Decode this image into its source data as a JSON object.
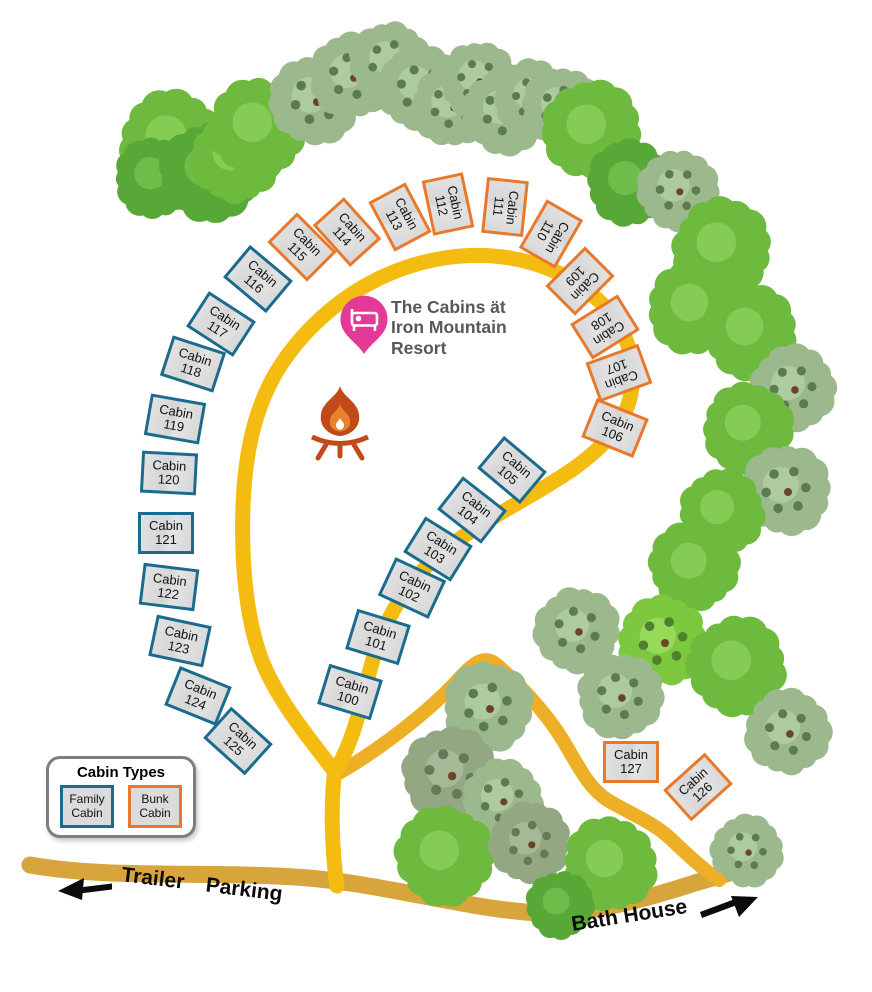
{
  "title": {
    "line1": "The Cabins ät",
    "line2": "Iron Mountain",
    "line3": "Resort"
  },
  "legend": {
    "title": "Cabin Types",
    "family_line1": "Family",
    "family_line2": "Cabin",
    "bunk_line1": "Bunk",
    "bunk_line2": "Cabin"
  },
  "labels": {
    "trailer_parking": "Trailer Parking",
    "bath_house": "Bath House",
    "cabin_word": "Cabin"
  },
  "colors": {
    "road_loop": "#F4BC10",
    "road_branch": "#ECAF25",
    "road_bottom": "#D8A43C",
    "family_border": "#1A6B8E",
    "bunk_border": "#E8782B",
    "cabin_fill": "#DBDBDB",
    "pin": "#E43A97",
    "fire": "#C14A18",
    "fire_inner": "#E8822F",
    "title_text": "#55585C",
    "arrow": "#0C0C0C"
  },
  "cabins": [
    {
      "num": "100",
      "type": "family",
      "x": 350,
      "y": 692,
      "rot": 17
    },
    {
      "num": "101",
      "type": "family",
      "x": 378,
      "y": 637,
      "rot": 17
    },
    {
      "num": "102",
      "type": "family",
      "x": 412,
      "y": 588,
      "rot": 25
    },
    {
      "num": "103",
      "type": "family",
      "x": 438,
      "y": 549,
      "rot": 32
    },
    {
      "num": "104",
      "type": "family",
      "x": 472,
      "y": 510,
      "rot": 38
    },
    {
      "num": "105",
      "type": "family",
      "x": 512,
      "y": 470,
      "rot": 40
    },
    {
      "num": "106",
      "type": "bunk",
      "x": 615,
      "y": 428,
      "rot": 22
    },
    {
      "num": "107",
      "type": "bunk",
      "x": 619,
      "y": 373,
      "rot": 160
    },
    {
      "num": "108",
      "type": "bunk",
      "x": 605,
      "y": 327,
      "rot": 148
    },
    {
      "num": "109",
      "type": "bunk",
      "x": 580,
      "y": 281,
      "rot": 135
    },
    {
      "num": "110",
      "type": "bunk",
      "x": 551,
      "y": 234,
      "rot": 120
    },
    {
      "num": "111",
      "type": "bunk",
      "x": 505,
      "y": 207,
      "rot": 96
    },
    {
      "num": "112",
      "type": "bunk",
      "x": 448,
      "y": 204,
      "rot": 78
    },
    {
      "num": "113",
      "type": "bunk",
      "x": 400,
      "y": 217,
      "rot": 62
    },
    {
      "num": "114",
      "type": "bunk",
      "x": 347,
      "y": 232,
      "rot": 48
    },
    {
      "num": "115",
      "type": "bunk",
      "x": 302,
      "y": 247,
      "rot": 45
    },
    {
      "num": "116",
      "type": "family",
      "x": 258,
      "y": 279,
      "rot": 40
    },
    {
      "num": "117",
      "type": "family",
      "x": 221,
      "y": 324,
      "rot": 33
    },
    {
      "num": "118",
      "type": "family",
      "x": 193,
      "y": 364,
      "rot": 18
    },
    {
      "num": "119",
      "type": "family",
      "x": 175,
      "y": 419,
      "rot": 10
    },
    {
      "num": "120",
      "type": "family",
      "x": 169,
      "y": 473,
      "rot": 3
    },
    {
      "num": "121",
      "type": "family",
      "x": 166,
      "y": 533,
      "rot": 0
    },
    {
      "num": "122",
      "type": "family",
      "x": 169,
      "y": 587,
      "rot": 7
    },
    {
      "num": "123",
      "type": "family",
      "x": 180,
      "y": 641,
      "rot": 12
    },
    {
      "num": "124",
      "type": "family",
      "x": 198,
      "y": 696,
      "rot": 22
    },
    {
      "num": "125",
      "type": "family",
      "x": 238,
      "y": 741,
      "rot": 42
    },
    {
      "num": "126",
      "type": "bunk",
      "x": 698,
      "y": 787,
      "rot": -42
    },
    {
      "num": "127",
      "type": "bunk",
      "x": 631,
      "y": 762,
      "rot": 0
    }
  ],
  "trees": [
    {
      "x": 172,
      "y": 142,
      "r": 46,
      "t": "b"
    },
    {
      "x": 155,
      "y": 178,
      "r": 36,
      "t": "m"
    },
    {
      "x": 210,
      "y": 172,
      "r": 44,
      "t": "m"
    },
    {
      "x": 236,
      "y": 158,
      "r": 40,
      "t": "b"
    },
    {
      "x": 258,
      "y": 128,
      "r": 44,
      "t": "b"
    },
    {
      "x": 315,
      "y": 100,
      "r": 40,
      "t": "s"
    },
    {
      "x": 352,
      "y": 76,
      "r": 38,
      "t": "s"
    },
    {
      "x": 390,
      "y": 62,
      "r": 36,
      "t": "s"
    },
    {
      "x": 420,
      "y": 88,
      "r": 38,
      "t": "s"
    },
    {
      "x": 452,
      "y": 106,
      "r": 36,
      "t": "s"
    },
    {
      "x": 478,
      "y": 80,
      "r": 34,
      "t": "s"
    },
    {
      "x": 505,
      "y": 112,
      "r": 38,
      "t": "s"
    },
    {
      "x": 533,
      "y": 98,
      "r": 34,
      "t": "s"
    },
    {
      "x": 562,
      "y": 108,
      "r": 36,
      "t": "s"
    },
    {
      "x": 592,
      "y": 130,
      "r": 44,
      "t": "b"
    },
    {
      "x": 630,
      "y": 183,
      "r": 38,
      "t": "m"
    },
    {
      "x": 678,
      "y": 190,
      "r": 36,
      "t": "s"
    },
    {
      "x": 722,
      "y": 248,
      "r": 44,
      "t": "b"
    },
    {
      "x": 695,
      "y": 308,
      "r": 42,
      "t": "b"
    },
    {
      "x": 750,
      "y": 332,
      "r": 42,
      "t": "b"
    },
    {
      "x": 793,
      "y": 388,
      "r": 38,
      "t": "s"
    },
    {
      "x": 748,
      "y": 428,
      "r": 40,
      "t": "b"
    },
    {
      "x": 786,
      "y": 490,
      "r": 40,
      "t": "s"
    },
    {
      "x": 722,
      "y": 512,
      "r": 38,
      "t": "b"
    },
    {
      "x": 694,
      "y": 566,
      "r": 40,
      "t": "b"
    },
    {
      "x": 577,
      "y": 630,
      "r": 38,
      "t": "s"
    },
    {
      "x": 663,
      "y": 641,
      "r": 40,
      "t": "l"
    },
    {
      "x": 620,
      "y": 696,
      "r": 38,
      "t": "s"
    },
    {
      "x": 737,
      "y": 666,
      "r": 44,
      "t": "b"
    },
    {
      "x": 788,
      "y": 732,
      "r": 38,
      "t": "s"
    },
    {
      "x": 488,
      "y": 707,
      "r": 40,
      "t": "s"
    },
    {
      "x": 450,
      "y": 774,
      "r": 42,
      "t": "g"
    },
    {
      "x": 502,
      "y": 800,
      "r": 36,
      "t": "s"
    },
    {
      "x": 445,
      "y": 856,
      "r": 44,
      "t": "b"
    },
    {
      "x": 530,
      "y": 843,
      "r": 36,
      "t": "g"
    },
    {
      "x": 610,
      "y": 864,
      "r": 42,
      "t": "b"
    },
    {
      "x": 560,
      "y": 905,
      "r": 30,
      "t": "m"
    },
    {
      "x": 747,
      "y": 851,
      "r": 32,
      "t": "s"
    }
  ]
}
